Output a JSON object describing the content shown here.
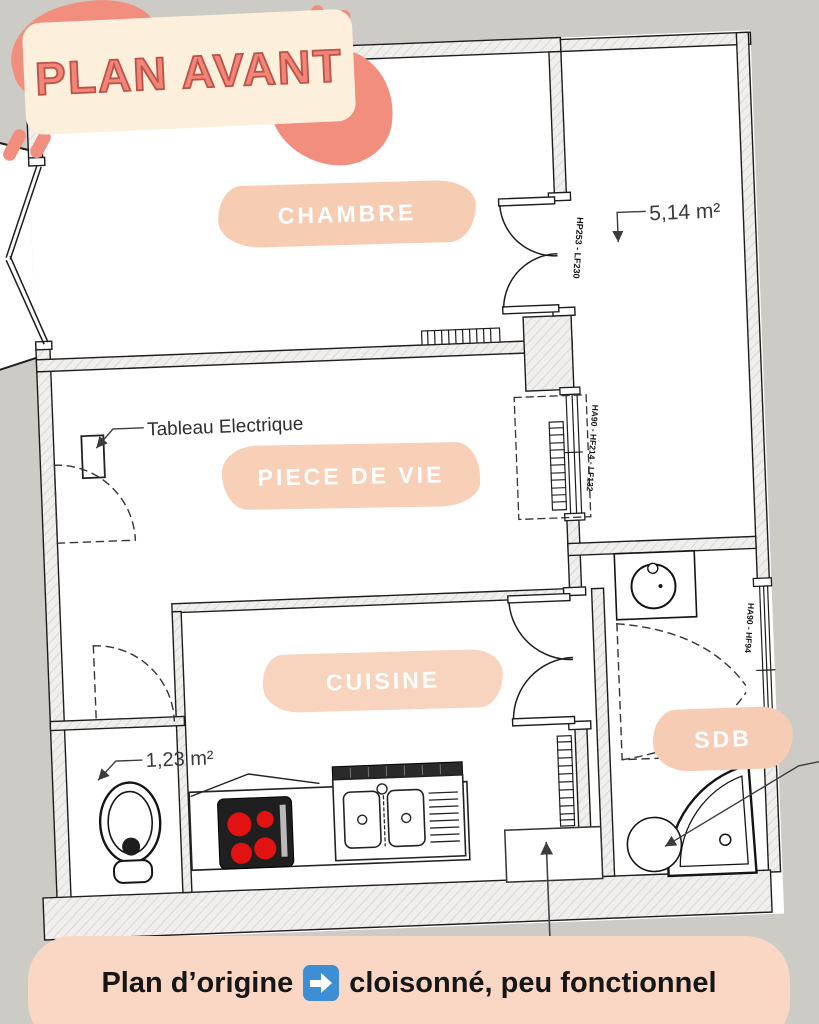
{
  "header": {
    "title": "PLAN AVANT"
  },
  "rooms": {
    "chambre": "CHAMBRE",
    "piece_de_vie": "PIECE DE VIE",
    "cuisine": "CUISINE",
    "sdb": "SDB"
  },
  "annotations": {
    "corridor_area": "5,14 m²",
    "wc_area": "1,23 m²",
    "electrical_panel": "Tableau Electrique",
    "window_chambre": "HP253 - LF230",
    "window_piece_de_vie": "HA90 - HF214 - LF132",
    "window_sdb": "HA90 - HF94"
  },
  "caption": {
    "before_arrow": "Plan d’origine",
    "arrow_icon": "right-arrow",
    "after_arrow": "cloisonné, peu fonctionnel"
  },
  "colors": {
    "background": "#cccbc5",
    "coral": "#f28e7e",
    "cream_card": "#fcf0dc",
    "title_text": "#f28577",
    "peach_label": "#f6cdb2",
    "peach_banner": "#f9d7c4",
    "arrow_blue": "#3d8ed4",
    "burner_red": "#e31212"
  }
}
